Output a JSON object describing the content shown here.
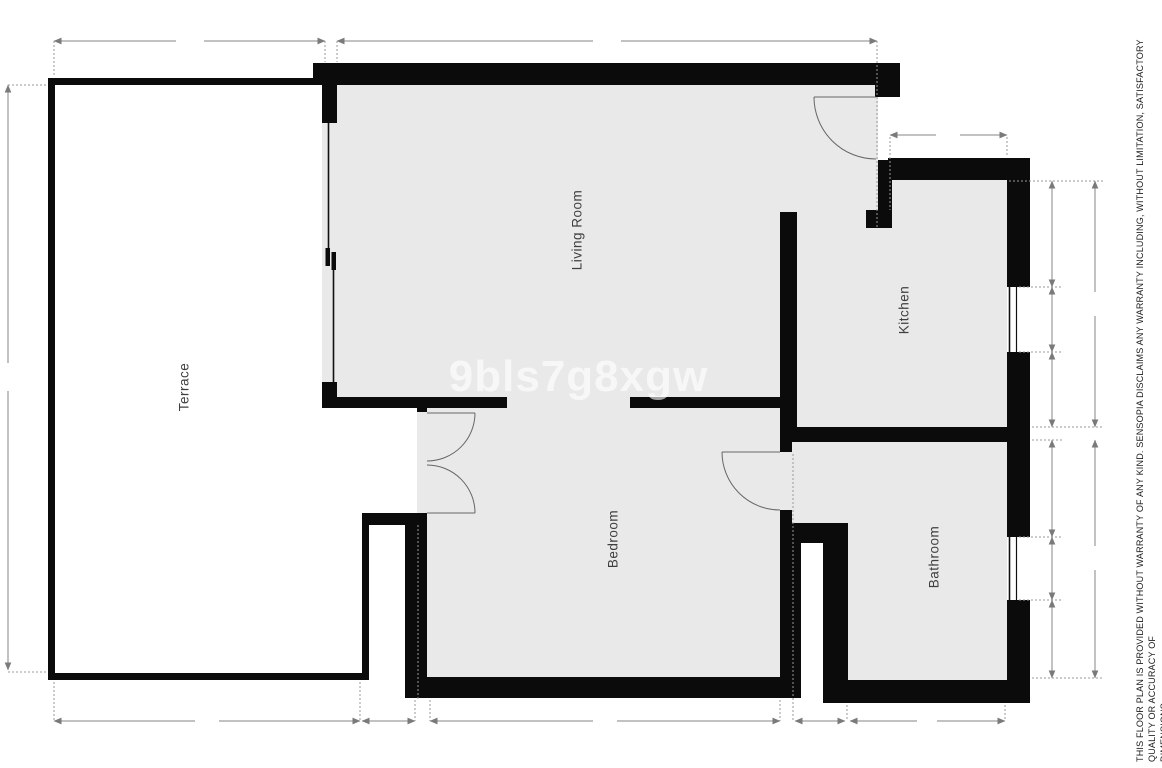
{
  "floor_plan": {
    "rooms": [
      {
        "name": "Terrace"
      },
      {
        "name": "Living Room"
      },
      {
        "name": "Bedroom"
      },
      {
        "name": "Kitchen"
      },
      {
        "name": "Bathroom"
      }
    ],
    "watermark": "9bls7g8xgw",
    "disclaimer": {
      "line1": "THIS FLOOR PLAN IS PROVIDED WITHOUT WARRANTY OF ANY KIND. SENSOPIA DISCLAIMS ANY WARRANTY INCLUDING, WITHOUT LIMITATION, SATISFACTORY QUALITY OR ACCURACY OF",
      "line2": "DIMENSIONS."
    },
    "colors": {
      "wall": "#0b0b0b",
      "room_fill": "#e9e9ea",
      "dimension_line": "#848484",
      "extension_line": "#9a9a9a",
      "door_arc": "#666666",
      "label_text": "#3f3f3f"
    }
  }
}
